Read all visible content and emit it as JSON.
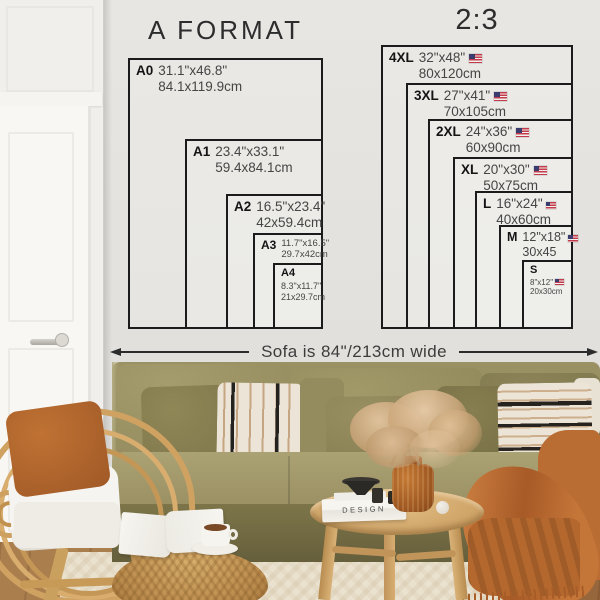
{
  "charts": {
    "a_format": {
      "title": "A FORMAT",
      "sizes": [
        {
          "label": "A0",
          "inches": "31.1\"x46.8\"",
          "cm": "84.1x119.9cm"
        },
        {
          "label": "A1",
          "inches": "23.4\"x33.1\"",
          "cm": "59.4x84.1cm"
        },
        {
          "label": "A2",
          "inches": "16.5\"x23.4\"",
          "cm": "42x59.4cm"
        },
        {
          "label": "A3",
          "inches": "11.7\"x16.5\"",
          "cm": "29.7x42cm"
        },
        {
          "label": "A4",
          "inches": "8.3\"x11.7\"",
          "cm": "21x29.7cm"
        }
      ]
    },
    "two_three": {
      "title": "2:3",
      "sizes": [
        {
          "label": "4XL",
          "inches": "32\"x48\"",
          "cm": "80x120cm",
          "flag": "us-flag"
        },
        {
          "label": "3XL",
          "inches": "27\"x41\"",
          "cm": "70x105cm",
          "flag": "us-flag"
        },
        {
          "label": "2XL",
          "inches": "24\"x36\"",
          "cm": "60x90cm",
          "flag": "us-flag"
        },
        {
          "label": "XL",
          "inches": "20\"x30\"",
          "cm": "50x75cm",
          "flag": "us-flag"
        },
        {
          "label": "L",
          "inches": "16\"x24\"",
          "cm": "40x60cm",
          "flag": "us-flag"
        },
        {
          "label": "M",
          "inches": "12\"x18\"",
          "cm": "30x45",
          "flag": "us-flag"
        },
        {
          "label": "S",
          "inches": "8\"x12\"",
          "cm": "20x30cm",
          "flag": "us-flag"
        }
      ]
    }
  },
  "sofa_note": "Sofa is 84\"/213cm wide",
  "decor": {
    "book_spine": "DESIGN"
  },
  "colors": {
    "chart_line": "#1b1b1b",
    "wall": "#e3e1dd",
    "door_white": "#f8f7f4",
    "sofa_olive": "#968d60",
    "pillow_rust": "#b4672a",
    "throw_orange": "#bc7036",
    "rattan_tan": "#d2a667",
    "rug_cream": "#eae2cf",
    "floor_wood": "#96663c",
    "flag_red": "#c23a4b",
    "flag_blue": "#3c3b6e"
  }
}
